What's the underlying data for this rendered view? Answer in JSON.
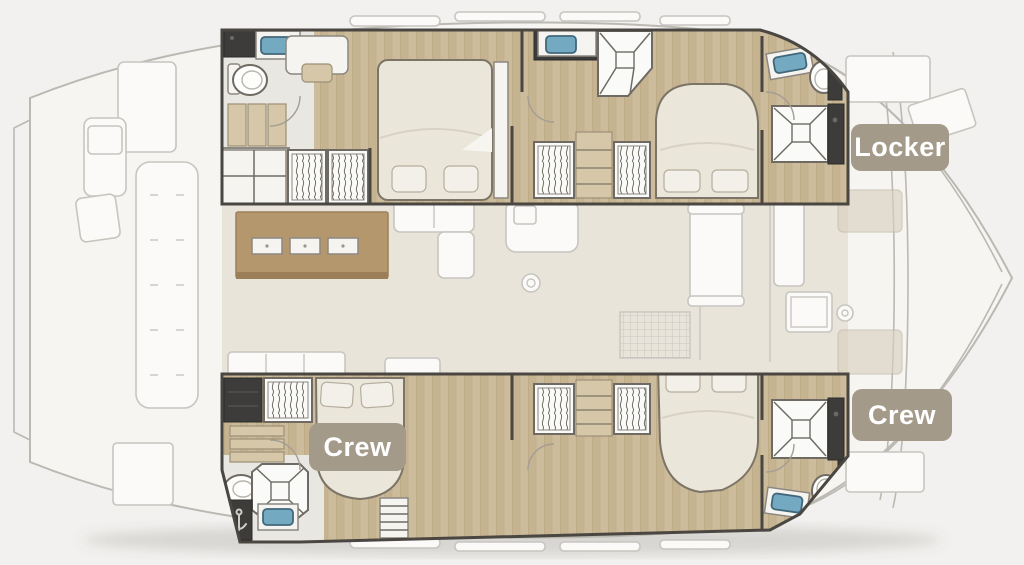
{
  "page": {
    "width": 1024,
    "height": 565,
    "description": "Catamaran yacht deck and cabin floor plan"
  },
  "labels": {
    "locker": "Locker",
    "crew_starboard": "Crew",
    "crew_port": "Crew"
  },
  "palette": {
    "page_bg": "#f2f1ef",
    "hull_fill": "#f6f5f2",
    "hull_line": "#bcb9b3",
    "faded_line": "#c8c5bf",
    "faded_fill": "#fbfaf8",
    "warm_floor": "#e9e4da",
    "wood": "#cdbc9c",
    "wood_dark": "#c5b390",
    "wall": "#4a4641",
    "dark_unit": "#3d3c3a",
    "white_furn": "#f5f4f0",
    "furn_stroke": "#8b8780",
    "bed_fill": "#ebe6da",
    "bed_stroke": "#7c7567",
    "pillow": "#f3f0e9",
    "sink_blue": "#74a9c2",
    "sink_dark": "#41677a",
    "tan_slat": "#d6c7a8",
    "island_brown": "#b5976e",
    "cushion_beige": "#d9cfbe",
    "badge_bg": "#a39a8a",
    "badge_text": "#ffffff"
  },
  "features": {
    "double_beds": 4,
    "showers": 4,
    "toilets": 4,
    "sinks": 5,
    "wardrobes_with_hangers": 6,
    "galley_island_placemats": 3,
    "label_badges": 3
  }
}
